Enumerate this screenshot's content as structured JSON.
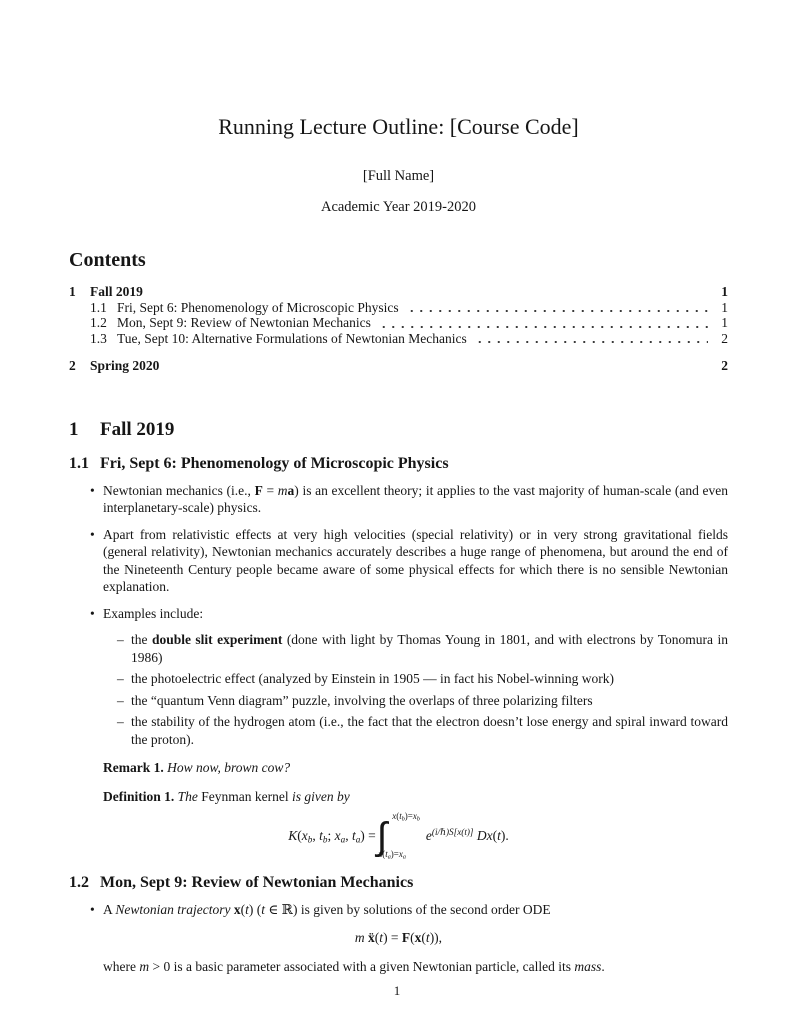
{
  "header": {
    "title": "Running Lecture Outline: [Course Code]",
    "author": "[Full Name]",
    "date_line": "Academic Year 2019-2020"
  },
  "contents": {
    "heading": "Contents",
    "entries": [
      {
        "num": "1",
        "label": "Fall 2019",
        "page": "1"
      },
      {
        "num": "1.1",
        "label": "Fri, Sept 6: Phenomenology of Microscopic Physics",
        "page": "1"
      },
      {
        "num": "1.2",
        "label": "Mon, Sept 9: Review of Newtonian Mechanics",
        "page": "1"
      },
      {
        "num": "1.3",
        "label": "Tue, Sept 10: Alternative Formulations of Newtonian Mechanics",
        "page": "2"
      },
      {
        "num": "2",
        "label": "Spring 2020",
        "page": "2"
      }
    ]
  },
  "section_fall": {
    "num": "1",
    "title": "Fall 2019"
  },
  "sub_phenomenology": {
    "num": "1.1",
    "title": "Fri, Sept 6: Phenomenology of Microscopic Physics",
    "bullet_newtonian": [
      {
        "t": "Newtonian mechanics (i.e., ",
        "s": "r"
      },
      {
        "t": "F",
        "s": "b"
      },
      {
        "t": " = ",
        "s": "r"
      },
      {
        "t": "m",
        "s": "i"
      },
      {
        "t": "a",
        "s": "b"
      },
      {
        "t": ") is an excellent theory; it applies to the vast majority of human-scale (and even interplanetary-scale) physics.",
        "s": "r"
      }
    ],
    "bullet_apart": [
      {
        "t": "Apart from relativistic effects at very high velocities (special relativity) or in very strong gravitational fields (general relativity), Newtonian mechanics accurately describes a huge range of phenomena, but around the end of the Nineteenth Century people became aware of some physical effects for which there is no sensible Newtonian explanation.",
        "s": "r"
      }
    ],
    "bullet_examples": [
      {
        "t": "Examples include:",
        "s": "r"
      }
    ],
    "item_double_slit": [
      {
        "t": "the ",
        "s": "r"
      },
      {
        "t": "double slit experiment",
        "s": "b"
      },
      {
        "t": " (done with light by Thomas Young in 1801, and with electrons by Tonomura in 1986)",
        "s": "r"
      }
    ],
    "item_photoelectric": [
      {
        "t": "the photoelectric effect (analyzed by Einstein in 1905 — in fact his Nobel-winning work)",
        "s": "r"
      }
    ],
    "item_venn": [
      {
        "t": "the “quantum Venn diagram” puzzle, involving the overlaps of three polarizing filters",
        "s": "r"
      }
    ],
    "item_hydrogen": [
      {
        "t": "the stability of the hydrogen atom (i.e., the fact that the electron doesn’t lose energy and spiral inward toward the proton).",
        "s": "r"
      }
    ],
    "remark": [
      {
        "t": "Remark 1.",
        "s": "b"
      },
      {
        "t": " How now, brown cow?",
        "s": "i"
      }
    ],
    "definition": [
      {
        "t": "Definition 1.",
        "s": "b"
      },
      {
        "t": " The ",
        "s": "i"
      },
      {
        "t": "Feynman kernel",
        "s": "r"
      },
      {
        "t": " is given by",
        "s": "i"
      }
    ],
    "kernel_formula": {
      "lhs": [
        {
          "t": "K",
          "s": "i"
        },
        {
          "t": "(",
          "s": "r"
        },
        {
          "t": "x",
          "s": "i"
        },
        {
          "t": "b",
          "s": "sub"
        },
        {
          "t": ", ",
          "s": "r"
        },
        {
          "t": "t",
          "s": "i"
        },
        {
          "t": "b",
          "s": "sub"
        },
        {
          "t": "; ",
          "s": "r"
        },
        {
          "t": "x",
          "s": "i"
        },
        {
          "t": "a",
          "s": "sub"
        },
        {
          "t": ", ",
          "s": "r"
        },
        {
          "t": "t",
          "s": "i"
        },
        {
          "t": "a",
          "s": "sub"
        },
        {
          "t": ") = ",
          "s": "r"
        }
      ],
      "integral_symbol": "∫",
      "upper_limit": [
        {
          "t": "x",
          "s": "i"
        },
        {
          "t": "(",
          "s": "r"
        },
        {
          "t": "t",
          "s": "i"
        },
        {
          "t": "b",
          "s": "sub"
        },
        {
          "t": ")=",
          "s": "r"
        },
        {
          "t": "x",
          "s": "i"
        },
        {
          "t": "b",
          "s": "sub"
        }
      ],
      "lower_limit": [
        {
          "t": "x",
          "s": "i"
        },
        {
          "t": "(",
          "s": "r"
        },
        {
          "t": "t",
          "s": "i"
        },
        {
          "t": "a",
          "s": "sub"
        },
        {
          "t": ")=",
          "s": "r"
        },
        {
          "t": "x",
          "s": "i"
        },
        {
          "t": "a",
          "s": "sub"
        }
      ],
      "rhs": [
        {
          "t": "e",
          "s": "i"
        },
        {
          "t": "(i/ℏ)S[x(t)]",
          "s": "sup"
        },
        {
          "t": " ",
          "s": "r"
        },
        {
          "t": "D",
          "s": "scr"
        },
        {
          "t": "x",
          "s": "i"
        },
        {
          "t": "(",
          "s": "r"
        },
        {
          "t": "t",
          "s": "i"
        },
        {
          "t": ").",
          "s": "r"
        }
      ]
    }
  },
  "sub_newtonian_review": {
    "num": "1.2",
    "title": "Mon, Sept 9: Review of Newtonian Mechanics",
    "bullet_trajectory": [
      {
        "t": "A ",
        "s": "r"
      },
      {
        "t": "Newtonian trajectory",
        "s": "i"
      },
      {
        "t": " ",
        "s": "r"
      },
      {
        "t": "x",
        "s": "b"
      },
      {
        "t": "(",
        "s": "r"
      },
      {
        "t": "t",
        "s": "i"
      },
      {
        "t": ") (",
        "s": "r"
      },
      {
        "t": "t",
        "s": "i"
      },
      {
        "t": " ∈ ℝ) is given by solutions of the second order ODE",
        "s": "r"
      }
    ],
    "ode_formula": [
      {
        "t": "m",
        "s": "i"
      },
      {
        "t": " ",
        "s": "r"
      },
      {
        "t": "ẍ",
        "s": "b"
      },
      {
        "t": "(",
        "s": "r"
      },
      {
        "t": "t",
        "s": "i"
      },
      {
        "t": ") = ",
        "s": "r"
      },
      {
        "t": "F",
        "s": "b"
      },
      {
        "t": "(",
        "s": "r"
      },
      {
        "t": "x",
        "s": "b"
      },
      {
        "t": "(",
        "s": "r"
      },
      {
        "t": "t",
        "s": "i"
      },
      {
        "t": ")),",
        "s": "r"
      }
    ],
    "mass_note": [
      {
        "t": "where ",
        "s": "r"
      },
      {
        "t": "m",
        "s": "i"
      },
      {
        "t": " > 0 is a basic parameter associated with a given Newtonian particle, called its ",
        "s": "r"
      },
      {
        "t": "mass",
        "s": "i"
      },
      {
        "t": ".",
        "s": "r"
      }
    ]
  },
  "footer": {
    "page_number": "1"
  }
}
